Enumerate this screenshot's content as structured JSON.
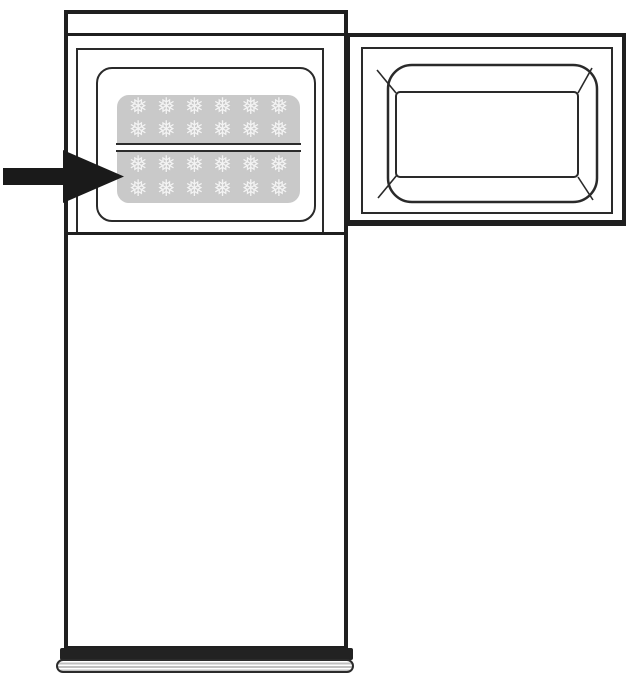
{
  "diagram": {
    "type": "appliance-line-drawing",
    "subject": "Top-freezer refrigerator with freezer door open; arrow points to stacked ice cube trays in the freezer compartment",
    "colors": {
      "background": "#ffffff",
      "line": "#1f1f1f",
      "tray_fill": "#c9c9c9",
      "snowflake": "#f3f3f3",
      "divider_gap": "#ffffff",
      "grille_stripe": "#c0c0c0",
      "arrow": "#1a1a1a"
    },
    "ice_tray_grid": {
      "trays": 2,
      "rows_per_tray": 2,
      "columns": 6,
      "glyph": "❅"
    },
    "base_grille": {
      "stripe_count": 4
    },
    "arrow": {
      "direction": "right",
      "points_to": "ice-cube-trays"
    }
  }
}
